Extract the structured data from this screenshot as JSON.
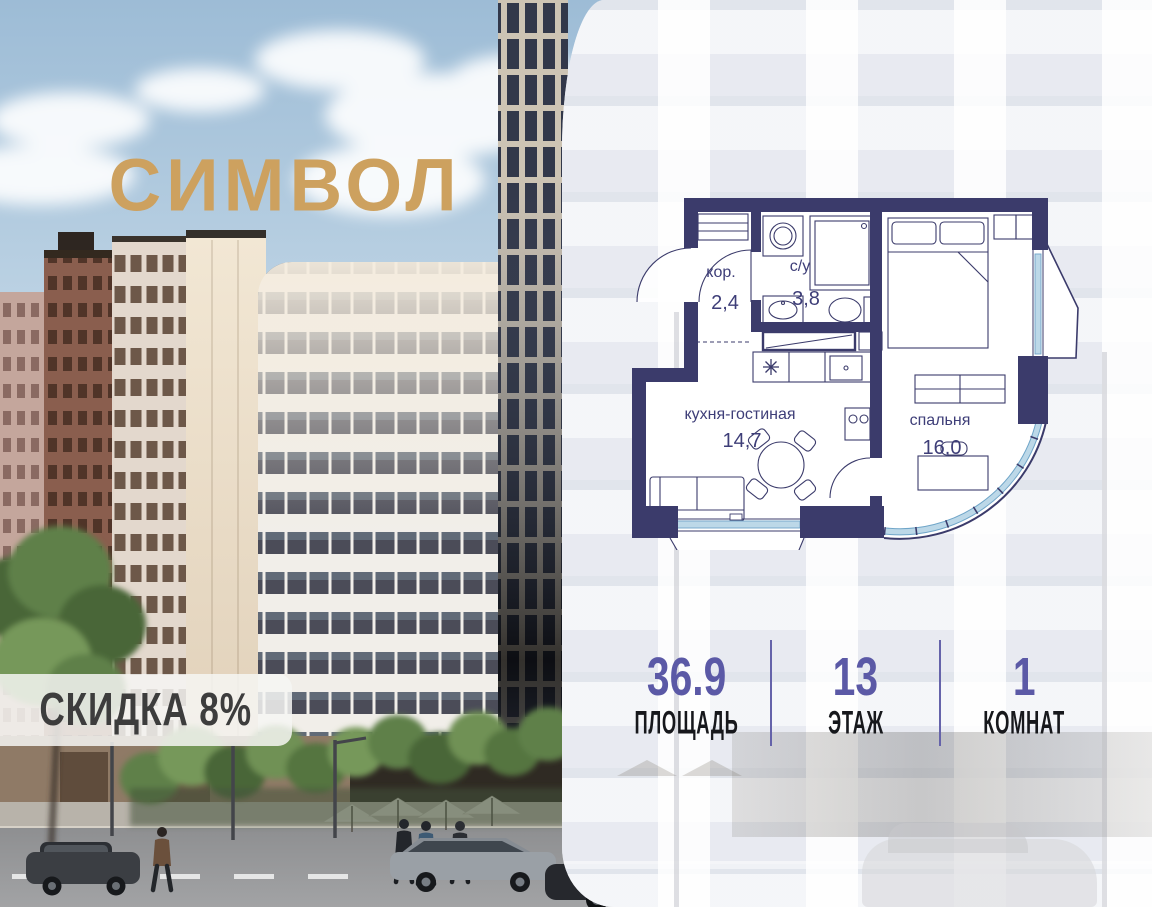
{
  "brand": {
    "name": "СИМВОЛ"
  },
  "badge": {
    "label": "СКИДКА 8%"
  },
  "floor_plan": {
    "rooms": [
      {
        "name": "кор.",
        "area": "2,4"
      },
      {
        "name": "с/у",
        "area": "3,8"
      },
      {
        "name": "кухня-гостиная",
        "area": "14,7"
      },
      {
        "name": "спальня",
        "area": "16,0"
      }
    ]
  },
  "stats": {
    "items": [
      {
        "value": "36.9",
        "label": "ПЛОЩАДЬ"
      },
      {
        "value": "13",
        "label": "ЭТАЖ"
      },
      {
        "value": "1",
        "label": "КОМНАТ"
      }
    ]
  },
  "colors": {
    "accent": "#5b59a6",
    "wall": "#3b3b6b",
    "glazing": "#8fc0da",
    "gold": "#cda15f"
  }
}
